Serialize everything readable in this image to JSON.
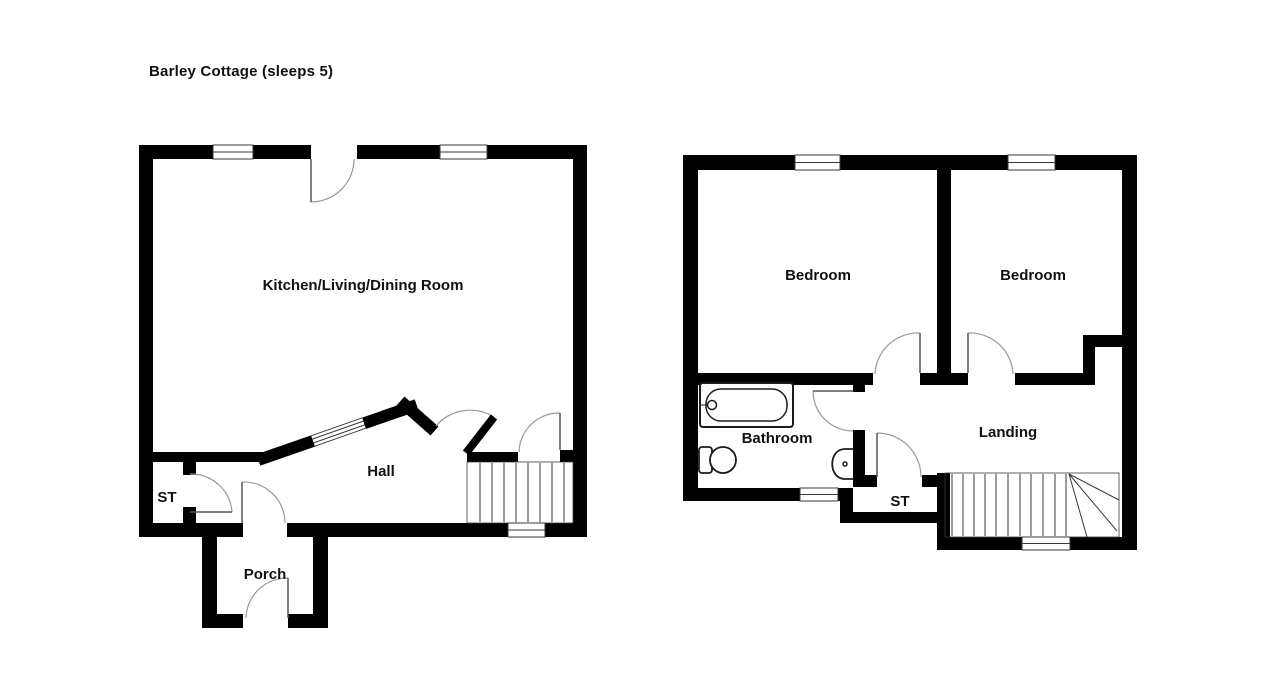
{
  "title": "Barley Cottage (sleeps 5)",
  "colors": {
    "wall": "#000000",
    "background": "#ffffff",
    "door_arc": "#999999",
    "door_leaf": "#555555",
    "thin_line": "#3a3a3a",
    "fixture": "#1c1c1c",
    "label": "#111111"
  },
  "label_font_size": 15,
  "floors": {
    "ground": {
      "name": "Ground floor",
      "labels": [
        {
          "id": "kitchen-living-dining",
          "text": "Kitchen/Living/Dining Room",
          "x": 363,
          "y": 290
        },
        {
          "id": "hall",
          "text": "Hall",
          "x": 381,
          "y": 476
        },
        {
          "id": "st",
          "text": "ST",
          "x": 167,
          "y": 502
        },
        {
          "id": "porch",
          "text": "Porch",
          "x": 265,
          "y": 579
        }
      ],
      "walls": [
        {
          "id": "top-a",
          "x": 139,
          "y": 145,
          "w": 74,
          "h": 14
        },
        {
          "id": "top-b",
          "x": 253,
          "y": 145,
          "w": 58,
          "h": 14
        },
        {
          "id": "top-c",
          "x": 357,
          "y": 145,
          "w": 83,
          "h": 14
        },
        {
          "id": "top-d",
          "x": 487,
          "y": 145,
          "w": 100,
          "h": 14
        },
        {
          "id": "left",
          "x": 139,
          "y": 145,
          "w": 14,
          "h": 392
        },
        {
          "id": "right",
          "x": 573,
          "y": 145,
          "w": 14,
          "h": 392
        },
        {
          "id": "bottom-a",
          "x": 139,
          "y": 523,
          "w": 104,
          "h": 14
        },
        {
          "id": "bottom-b",
          "x": 287,
          "y": 523,
          "w": 221,
          "h": 14
        },
        {
          "id": "bottom-c",
          "x": 545,
          "y": 523,
          "w": 42,
          "h": 14
        },
        {
          "id": "hall-wall-left",
          "x": 150,
          "y": 452,
          "w": 118,
          "h": 10
        },
        {
          "id": "hall-wall-right",
          "x": 467,
          "y": 452,
          "w": 51,
          "h": 10
        },
        {
          "id": "hall-stub-right",
          "x": 560,
          "y": 450,
          "w": 14,
          "h": 12
        },
        {
          "id": "st-stub-top",
          "x": 183,
          "y": 462,
          "w": 13,
          "h": 13
        },
        {
          "id": "st-stub-bottom",
          "x": 183,
          "y": 507,
          "w": 13,
          "h": 16
        },
        {
          "id": "porch-left",
          "x": 202,
          "y": 537,
          "w": 15,
          "h": 91
        },
        {
          "id": "porch-right",
          "x": 313,
          "y": 537,
          "w": 15,
          "h": 91
        },
        {
          "id": "porch-bottom-a",
          "x": 202,
          "y": 614,
          "w": 41,
          "h": 14
        },
        {
          "id": "porch-bottom-b",
          "x": 288,
          "y": 614,
          "w": 40,
          "h": 14
        }
      ],
      "diag_walls": [
        {
          "id": "kitchen-hall-diagonal",
          "x1": 264,
          "y1": 458,
          "x2": 411,
          "y2": 407,
          "t": 12
        },
        {
          "id": "diagonal-bend",
          "x1": 405,
          "y1": 405,
          "x2": 430,
          "y2": 427,
          "t": 12
        }
      ],
      "windows": [
        {
          "id": "window-top-left",
          "x": 213,
          "y": 145,
          "w": 40,
          "h": 14
        },
        {
          "id": "window-top-right",
          "x": 440,
          "y": 145,
          "w": 47,
          "h": 14
        },
        {
          "id": "window-bottom-stairs",
          "x": 508,
          "y": 523,
          "w": 37,
          "h": 14
        }
      ],
      "diag_windows": [
        {
          "id": "window-diagonal",
          "x1": 313,
          "y1": 441,
          "x2": 364,
          "y2": 423,
          "t": 12
        }
      ],
      "doors": [
        {
          "id": "door-kitchen-front",
          "leaf": [
            311,
            159,
            311,
            202
          ],
          "leaf_w": 1.5,
          "arc": {
            "sx": 311,
            "sy": 202,
            "ex": 354,
            "ey": 159,
            "r": 43,
            "sweep": 0
          }
        },
        {
          "id": "door-st",
          "leaf": [
            190,
            512,
            232,
            512
          ],
          "leaf_w": 1.5,
          "arc": {
            "sx": 232,
            "sy": 512,
            "ex": 190,
            "ey": 474,
            "r": 41,
            "sweep": 0
          }
        },
        {
          "id": "door-porch-inner",
          "leaf": [
            242,
            523,
            242,
            482
          ],
          "leaf_w": 1.5,
          "arc": {
            "sx": 242,
            "sy": 482,
            "ex": 285,
            "ey": 523,
            "r": 41,
            "sweep": 1
          }
        },
        {
          "id": "door-porch-front",
          "leaf": [
            288,
            618,
            288,
            578
          ],
          "leaf_w": 1.5,
          "arc": {
            "sx": 288,
            "sy": 578,
            "ex": 246,
            "ey": 618,
            "r": 41,
            "sweep": 0
          }
        },
        {
          "id": "door-kitchen-hall",
          "leaf": [
            466,
            453,
            494,
            417
          ],
          "leaf_w": 8,
          "leaf_black": true,
          "arc": {
            "sx": 494,
            "sy": 417,
            "ex": 436,
            "ey": 426,
            "r": 45,
            "sweep": 0
          }
        },
        {
          "id": "door-hall-stairs",
          "leaf": [
            560,
            450,
            560,
            413
          ],
          "leaf_w": 1.5,
          "arc": {
            "sx": 560,
            "sy": 413,
            "ex": 519,
            "ey": 452,
            "r": 40,
            "sweep": 0
          }
        }
      ],
      "stairs": {
        "id": "stairs-ground",
        "x": 467,
        "y": 462,
        "w": 106,
        "h": 61,
        "treads_x": [
          480,
          492,
          504,
          516,
          528,
          540,
          552,
          564
        ],
        "fan": null
      },
      "fixtures": []
    },
    "first": {
      "name": "First floor",
      "labels": [
        {
          "id": "bedroom-left",
          "text": "Bedroom",
          "x": 818,
          "y": 280
        },
        {
          "id": "bedroom-right",
          "text": "Bedroom",
          "x": 1033,
          "y": 280
        },
        {
          "id": "bathroom",
          "text": "Bathroom",
          "x": 777,
          "y": 443
        },
        {
          "id": "landing",
          "text": "Landing",
          "x": 1008,
          "y": 437
        },
        {
          "id": "st",
          "text": "ST",
          "x": 900,
          "y": 506
        }
      ],
      "walls": [
        {
          "id": "top-a",
          "x": 683,
          "y": 155,
          "w": 112,
          "h": 15
        },
        {
          "id": "top-b",
          "x": 840,
          "y": 155,
          "w": 168,
          "h": 15
        },
        {
          "id": "top-c",
          "x": 1055,
          "y": 155,
          "w": 82,
          "h": 15
        },
        {
          "id": "left",
          "x": 683,
          "y": 155,
          "w": 15,
          "h": 346
        },
        {
          "id": "right",
          "x": 1122,
          "y": 155,
          "w": 15,
          "h": 395
        },
        {
          "id": "bath-bottom-a",
          "x": 683,
          "y": 488,
          "w": 117,
          "h": 13
        },
        {
          "id": "bath-bottom-b",
          "x": 838,
          "y": 488,
          "w": 15,
          "h": 13
        },
        {
          "id": "step-wall",
          "x": 840,
          "y": 488,
          "w": 13,
          "h": 35
        },
        {
          "id": "st-bottom",
          "x": 840,
          "y": 512,
          "w": 110,
          "h": 11
        },
        {
          "id": "st-stairs-wall",
          "x": 937,
          "y": 473,
          "w": 13,
          "h": 77
        },
        {
          "id": "stairs-bottom-a",
          "x": 937,
          "y": 537,
          "w": 85,
          "h": 13
        },
        {
          "id": "stairs-bottom-b",
          "x": 1070,
          "y": 537,
          "w": 67,
          "h": 13
        },
        {
          "id": "bedroom-divider",
          "x": 937,
          "y": 170,
          "w": 14,
          "h": 204
        },
        {
          "id": "bedroom-bottom-a",
          "x": 690,
          "y": 373,
          "w": 183,
          "h": 12
        },
        {
          "id": "bedroom-bottom-b",
          "x": 920,
          "y": 373,
          "w": 48,
          "h": 12
        },
        {
          "id": "bedroom-bottom-c",
          "x": 1015,
          "y": 373,
          "w": 80,
          "h": 12
        },
        {
          "id": "notch-vertical",
          "x": 1083,
          "y": 335,
          "w": 12,
          "h": 50
        },
        {
          "id": "notch-horizontal",
          "x": 1083,
          "y": 335,
          "w": 39,
          "h": 12
        },
        {
          "id": "bath-right-a",
          "x": 853,
          "y": 383,
          "w": 12,
          "h": 9
        },
        {
          "id": "bath-right-b",
          "x": 853,
          "y": 430,
          "w": 12,
          "h": 57
        },
        {
          "id": "st-top-stub-left",
          "x": 853,
          "y": 475,
          "w": 24,
          "h": 12
        },
        {
          "id": "st-top-stub-right",
          "x": 922,
          "y": 475,
          "w": 20,
          "h": 12
        }
      ],
      "diag_walls": [],
      "windows": [
        {
          "id": "window-top-left",
          "x": 795,
          "y": 155,
          "w": 45,
          "h": 15
        },
        {
          "id": "window-top-right",
          "x": 1008,
          "y": 155,
          "w": 47,
          "h": 15
        },
        {
          "id": "window-bathroom",
          "x": 800,
          "y": 488,
          "w": 38,
          "h": 13
        },
        {
          "id": "window-stairs",
          "x": 1022,
          "y": 537,
          "w": 48,
          "h": 13
        }
      ],
      "diag_windows": [],
      "doors": [
        {
          "id": "door-bedroom-left",
          "leaf": [
            920,
            333,
            920,
            373
          ],
          "leaf_w": 1.5,
          "arc": {
            "sx": 920,
            "sy": 333,
            "ex": 875,
            "ey": 374,
            "r": 43,
            "sweep": 0
          }
        },
        {
          "id": "door-bedroom-right",
          "leaf": [
            968,
            333,
            968,
            373
          ],
          "leaf_w": 1.5,
          "arc": {
            "sx": 968,
            "sy": 333,
            "ex": 1013,
            "ey": 374,
            "r": 43,
            "sweep": 1
          }
        },
        {
          "id": "door-bathroom",
          "leaf": [
            813,
            391,
            853,
            391
          ],
          "leaf_w": 1.5,
          "arc": {
            "sx": 813,
            "sy": 391,
            "ex": 853,
            "ey": 431,
            "r": 40,
            "sweep": 0
          }
        },
        {
          "id": "door-st",
          "leaf": [
            877,
            433,
            877,
            477
          ],
          "leaf_w": 1.5,
          "arc": {
            "sx": 877,
            "sy": 433,
            "ex": 921,
            "ey": 477,
            "r": 44,
            "sweep": 1
          }
        }
      ],
      "stairs": {
        "id": "stairs-first",
        "x": 945,
        "y": 473,
        "w": 174,
        "h": 64,
        "treads_x": [
          952,
          963,
          974,
          985,
          996,
          1008,
          1020,
          1031,
          1043,
          1055,
          1066
        ],
        "fan": {
          "cx": 1069,
          "cy": 474,
          "points": [
            [
              1119,
              500
            ],
            [
              1117,
              531
            ],
            [
              1087,
              537
            ]
          ]
        }
      },
      "fixtures": [
        {
          "id": "bathtub-outer",
          "kind": "rect",
          "x": 700,
          "y": 383,
          "w": 93,
          "h": 44,
          "rx": 3,
          "sw": 2
        },
        {
          "id": "bathtub-inner",
          "kind": "rect",
          "x": 706,
          "y": 389,
          "w": 81,
          "h": 32,
          "rx": 15,
          "sw": 1.5
        },
        {
          "id": "bathtub-drain",
          "kind": "circle",
          "cx": 712,
          "cy": 405,
          "r": 4.5,
          "sw": 1.5
        },
        {
          "id": "bathtub-tap",
          "kind": "line",
          "x1": 700,
          "y1": 405,
          "x2": 707,
          "y2": 405,
          "sw": 1
        },
        {
          "id": "toilet-tank",
          "kind": "rect",
          "x": 699,
          "y": 447,
          "w": 13,
          "h": 26,
          "rx": 3,
          "sw": 1.8
        },
        {
          "id": "toilet-bowl",
          "kind": "circle",
          "cx": 723,
          "cy": 460,
          "r": 13,
          "sw": 1.8
        },
        {
          "id": "sink-basin",
          "kind": "path",
          "d": "M 853 449 L 845 449 C 828 449 828 479 845 479 L 853 479",
          "sw": 1.8
        },
        {
          "id": "sink-drain",
          "kind": "circle",
          "cx": 845,
          "cy": 464,
          "r": 2,
          "sw": 1.5
        }
      ]
    }
  }
}
